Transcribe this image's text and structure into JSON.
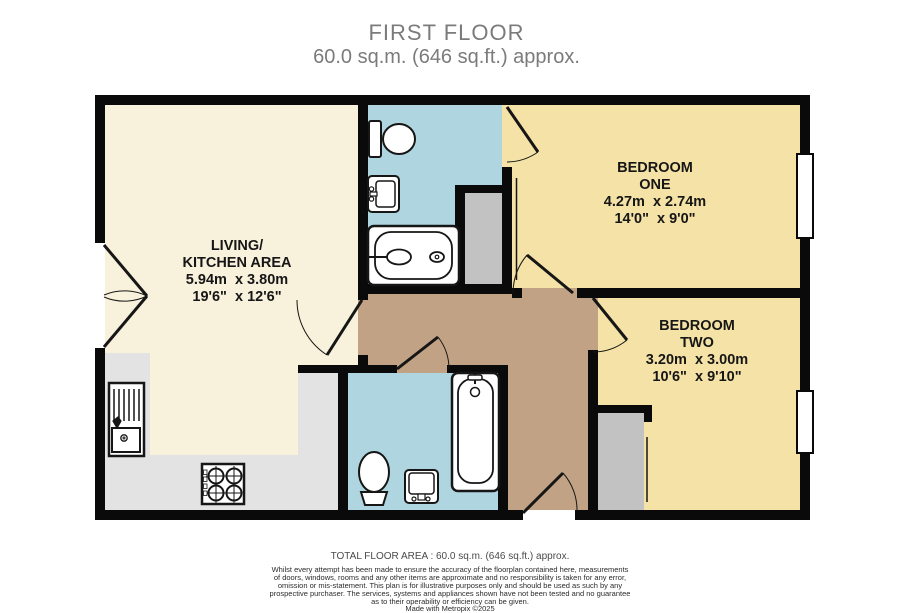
{
  "title": {
    "line1": "FIRST FLOOR",
    "line2": "60.0 sq.m. (646 sq.ft.) approx."
  },
  "rooms": {
    "living": {
      "name_line1": "LIVING/",
      "name_line2": "KITCHEN AREA",
      "metric": "5.94m  x 3.80m",
      "imperial": "19'6\"  x 12'6\""
    },
    "bedroom_one": {
      "name_line1": "BEDROOM",
      "name_line2": "ONE",
      "metric": "4.27m  x 2.74m",
      "imperial": "14'0\"  x 9'0\""
    },
    "bedroom_two": {
      "name_line1": "BEDROOM",
      "name_line2": "TWO",
      "metric": "3.20m  x 3.00m",
      "imperial": "10'6\"  x 9'10\""
    }
  },
  "fixtures": {
    "bathroom_top": [
      "toilet-icon",
      "sink-icon",
      "bathtub-icon"
    ],
    "bathroom_bottom": [
      "toilet-icon",
      "sink-icon",
      "bathtub-icon"
    ],
    "kitchen": [
      "kitchen-sink-icon",
      "hob-icon"
    ],
    "storage": [
      "closet",
      "closet"
    ]
  },
  "colors": {
    "wall": "#0a0a0a",
    "living": "#f8f1db",
    "bedroom": "#f5e2a6",
    "bathroom": "#afd6e0",
    "hallway": "#c2a284",
    "counter": "#e3e3e3",
    "closet": "#c2c2c2",
    "title_text": "#7b7b7b"
  },
  "footer": {
    "total": "TOTAL FLOOR AREA : 60.0 sq.m. (646 sq.ft.) approx.",
    "disclaimer_lines": [
      "Whilst every attempt has been made to ensure the accuracy of the floorplan contained here, measurements",
      "of doors, windows, rooms and any other items are approximate and no responsibility is taken for any error,",
      "omission or mis-statement. This plan is for illustrative purposes only and should be used as such by any",
      "prospective purchaser. The services, systems and appliances shown have not been tested and no guarantee",
      "as to their operability or efficiency can be given."
    ],
    "credit": "Made with Metropix ©2025"
  }
}
